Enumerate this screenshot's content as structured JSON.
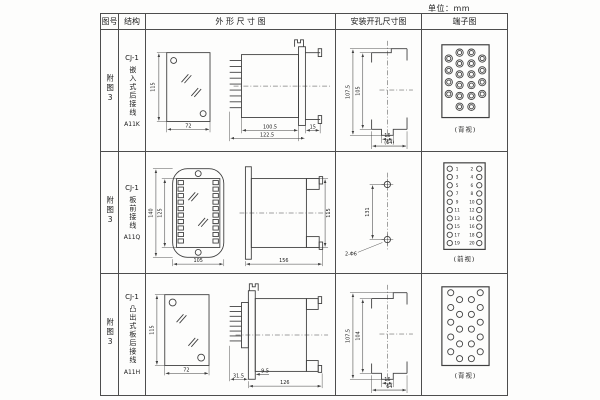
{
  "page": {
    "unit": "单位：mm"
  },
  "header": {
    "col_fig": "图号",
    "col_struct": "结构",
    "col_outline": "外 形 尺 寸 图",
    "col_mount": "安装开孔尺寸图",
    "col_terminal": "端子图"
  },
  "rows": [
    {
      "fig": "附图3",
      "model": "CJ-1",
      "type": "嵌入式后接线",
      "code": "A11K",
      "dims": {
        "h": "115",
        "w": "72",
        "d1": "100.5",
        "d2": "122.5",
        "flange": "15"
      },
      "mount": {
        "h1": "107.5",
        "h2": "105",
        "w1": "16",
        "w2": "(64)"
      },
      "view": "(背视)",
      "terminal_count": 20
    },
    {
      "fig": "附图3",
      "model": "CJ-1",
      "type": "板前接线",
      "code": "A11Q",
      "dims": {
        "h1": "140",
        "h2": "125",
        "w": "105",
        "d": "156",
        "sh": "115"
      },
      "mount": {
        "spacing": "131",
        "holes": "2-Φ6"
      },
      "view": "(前视)",
      "terminal_count": 20,
      "left_nums": [
        "1",
        "3",
        "5",
        "7",
        "9",
        "11",
        "13",
        "15",
        "17",
        "19"
      ],
      "right_nums": [
        "2",
        "4",
        "6",
        "8",
        "10",
        "12",
        "14",
        "16",
        "18",
        "20"
      ]
    },
    {
      "fig": "附图3",
      "model": "CJ-1",
      "type": "凸出式板后接线",
      "code": "A11H",
      "dims": {
        "h": "115",
        "w": "72",
        "pin": "31.5",
        "off": "9.5",
        "d": "126"
      },
      "mount": {
        "h1": "107.5",
        "h2": "104",
        "w1": "16",
        "w2": "64"
      },
      "view": "(背视)",
      "terminal_count": 20
    }
  ]
}
